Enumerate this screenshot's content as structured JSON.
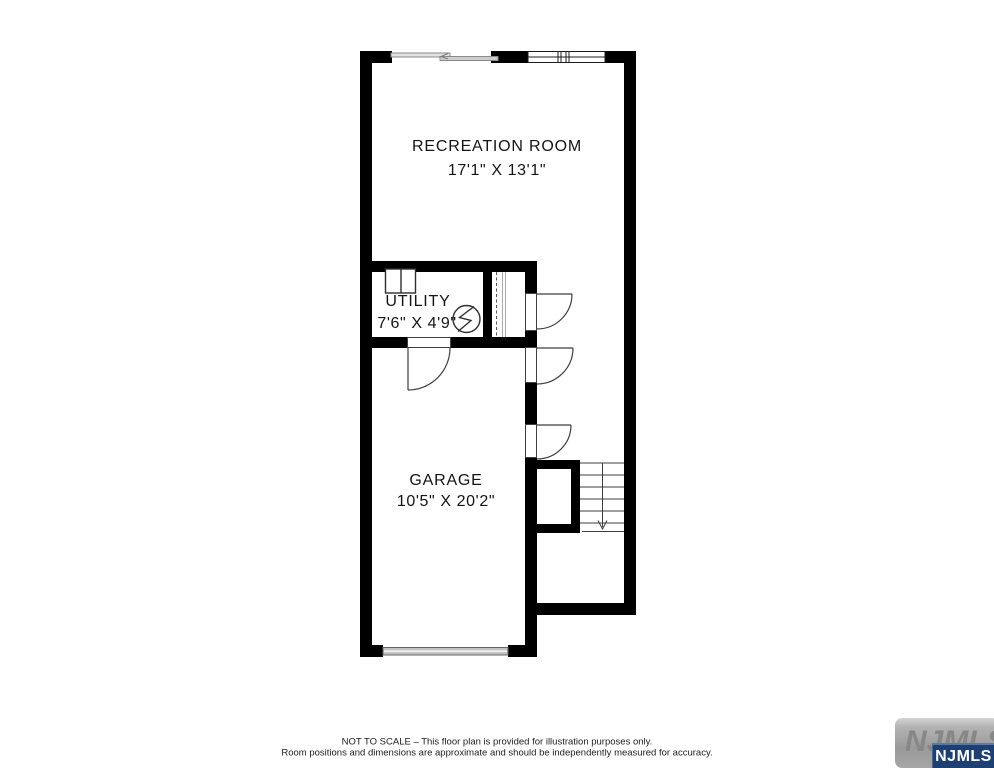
{
  "plan": {
    "rooms": [
      {
        "name": "RECREATION ROOM",
        "dims": "17'1\" X 13'1\""
      },
      {
        "name": "UTILITY",
        "dims": "7'6\" X 4'9\""
      },
      {
        "name": "GARAGE",
        "dims": "10'5\" X 20'2\""
      }
    ],
    "features": [
      "sliding-door",
      "window",
      "closet-with-rod",
      "water-heater-symbol",
      "washer-dryer",
      "swing-doors",
      "staircase-down",
      "garage-door"
    ]
  },
  "footer": {
    "line1": "NOT TO SCALE – This floor plan is provided for illustration purposes only.",
    "line2": "Room positions and dimensions are approximate and should be independently measured for accuracy."
  },
  "logo": {
    "watermark": "NJMLS",
    "badge": "NJMLS"
  },
  "colors": {
    "background": "#ffffff",
    "wall": "#000000",
    "thin_line": "#3f3f3f",
    "gray_fixture": "#c2c2c2",
    "badge_navy": "#1d3f72",
    "badge_text": "#ffffff",
    "watermark_gray": "#9a9a9a"
  }
}
